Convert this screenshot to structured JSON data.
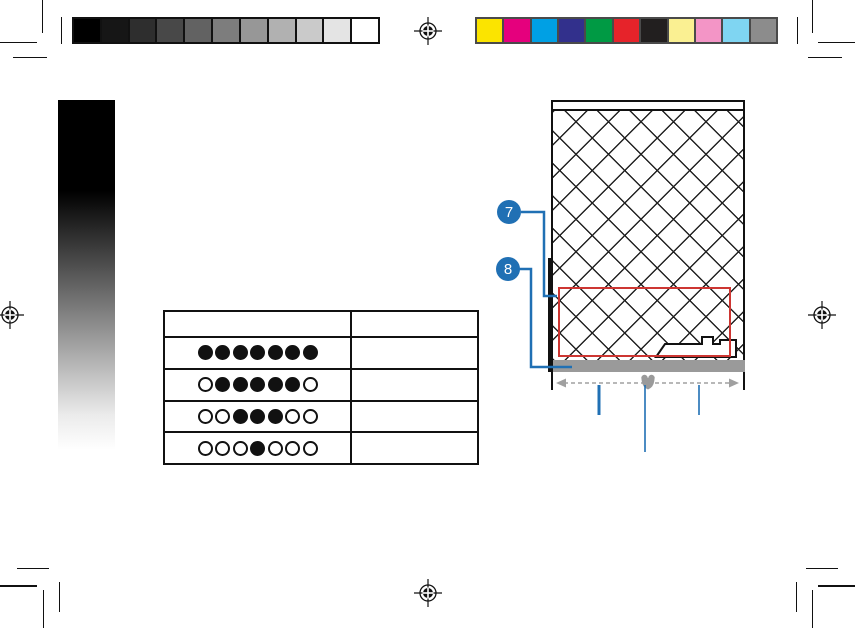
{
  "print_marks": {
    "grayscale_steps": [
      "#000000",
      "#161616",
      "#2e2e2e",
      "#484848",
      "#626262",
      "#7d7d7d",
      "#979797",
      "#b1b1b1",
      "#cacaca",
      "#e4e4e4",
      "#ffffff"
    ],
    "color_swatches": [
      "#fbe400",
      "#e5007d",
      "#00a0e4",
      "#32308c",
      "#009a44",
      "#e6232a",
      "#221f1f",
      "#faf092",
      "#f395c6",
      "#7fd5f2",
      "#8c8c8c"
    ]
  },
  "gradient_bar": {
    "top_color": "#000000",
    "bottom_color": "#ffffff"
  },
  "led_table": {
    "header": {
      "led_column": "",
      "description_column": ""
    },
    "rows": [
      {
        "leds": [
          1,
          1,
          1,
          1,
          1,
          1,
          1
        ],
        "label": ""
      },
      {
        "leds": [
          0,
          1,
          1,
          1,
          1,
          1,
          0
        ],
        "label": ""
      },
      {
        "leds": [
          0,
          0,
          1,
          1,
          1,
          0,
          0
        ],
        "label": ""
      },
      {
        "leds": [
          0,
          0,
          0,
          1,
          0,
          0,
          0
        ],
        "label": ""
      }
    ]
  },
  "device_figure": {
    "callouts": [
      {
        "number": "7"
      },
      {
        "number": "8"
      }
    ],
    "colors": {
      "callout_blue": "#2070b4",
      "highlight_red": "#cd3632",
      "base_gray": "#9a9a9a",
      "arrow_gray": "#a0a0a0"
    }
  }
}
